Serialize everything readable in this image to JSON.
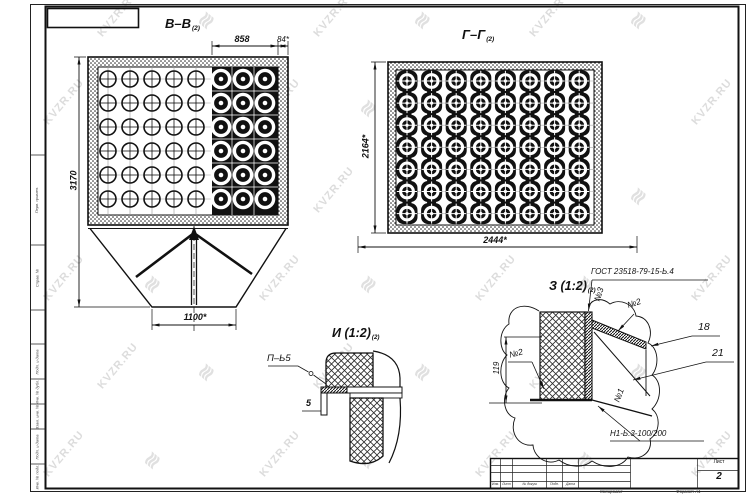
{
  "watermark": {
    "text": "KVZR.RU",
    "logo_glyph": "≋"
  },
  "drawing": {
    "section_bb": {
      "title": "В–В",
      "title_sub": "(2)",
      "dims": {
        "height": "3170",
        "top_span": "858",
        "top_edge": "84*",
        "outlet": "1100*"
      }
    },
    "section_gg": {
      "title": "Г–Г",
      "title_sub": "(2)",
      "dims": {
        "width": "2444*",
        "height": "2164*"
      }
    },
    "detail_i": {
      "title": "И (1:2)",
      "title_sub": "(2)",
      "weld_label": "П–Ь5",
      "dim_thickness": "5"
    },
    "detail_z": {
      "title": "З (1:2)",
      "title_sub": "(2)",
      "gost_label": "ГОСТ 23518-79-15-Ь.4",
      "pos_3": "№3",
      "pos_2_right": "№2",
      "item_18": "18",
      "item_21": "21",
      "pos_2_left": "№2",
      "dim_height": "119",
      "pos_1": "№1",
      "weld_label": "Н1-Ь.3-100/200"
    }
  },
  "frame": {
    "sheet_caption": "Лист",
    "sheet_number": "2",
    "footer_left": "Копировал",
    "footer_right": "Формат А1",
    "stamp_columns": [
      "Изм.",
      "Лист",
      "№ докум.",
      "Подп.",
      "Дата"
    ],
    "side_stamps": [
      "Перв. примен.",
      "Справ. №",
      "Подп. и дата",
      "Инв. № дубл.",
      "Взам. инв. №",
      "Подп. и дата",
      "Инв. № подл."
    ]
  }
}
